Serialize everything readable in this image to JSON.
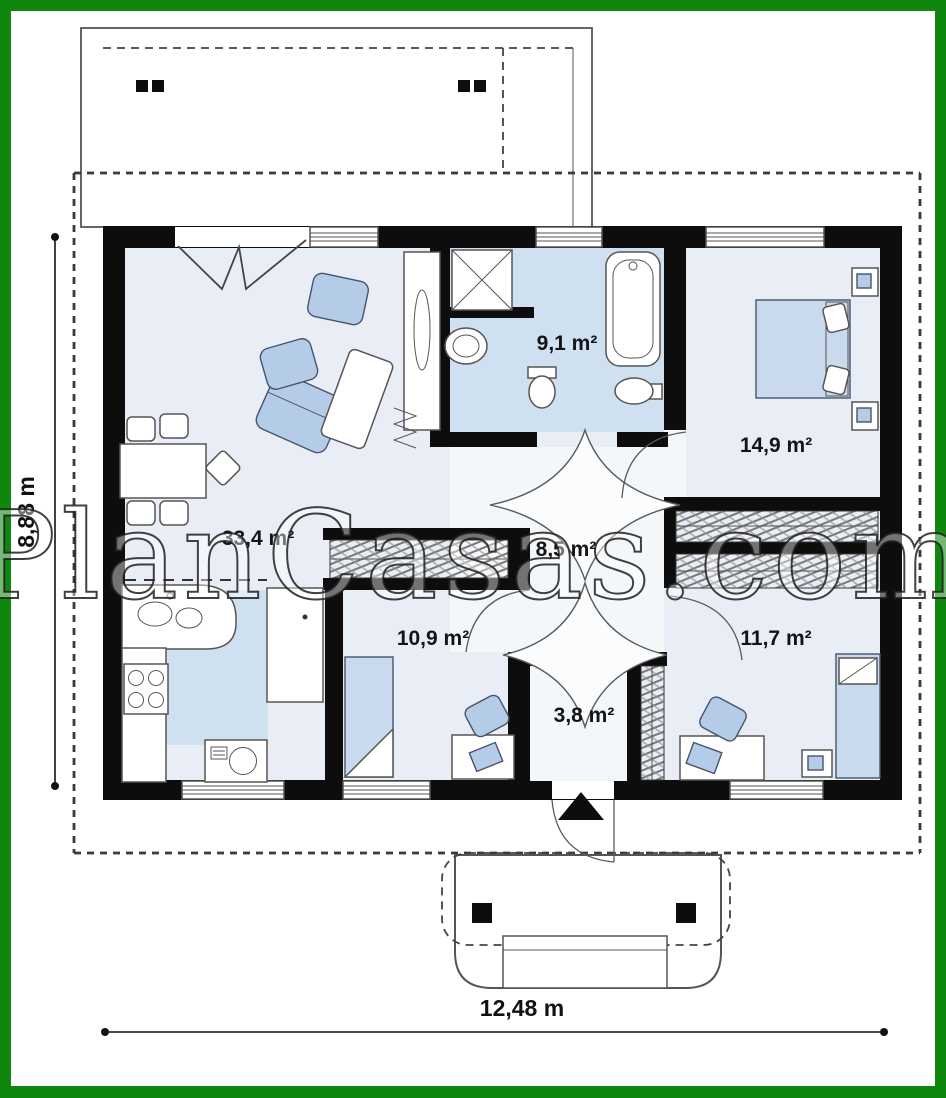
{
  "frame": {
    "border_color": "#0f870f",
    "background": "#ffffff"
  },
  "watermark": {
    "text": "PlanCasas.com"
  },
  "plan": {
    "rooms": [
      {
        "id": "living-dining",
        "area_label": "33,4 m²"
      },
      {
        "id": "bathroom",
        "area_label": "9,1 m²"
      },
      {
        "id": "bedroom-1",
        "area_label": "14,9 m²"
      },
      {
        "id": "hall",
        "area_label": "8,5 m²"
      },
      {
        "id": "bedroom-2",
        "area_label": "10,9 m²"
      },
      {
        "id": "bedroom-3",
        "area_label": "11,7 m²"
      },
      {
        "id": "entry",
        "area_label": "3,8 m²"
      }
    ],
    "dimensions": {
      "depth": "8,88 m",
      "width": "12,48 m"
    },
    "colors": {
      "frame": "#0f870f",
      "wall": "#0d0d0d",
      "floor": "#e9eef6",
      "wet": "#cfe0f1",
      "furn": "#b5cce8",
      "bed": "#c9daee"
    }
  }
}
